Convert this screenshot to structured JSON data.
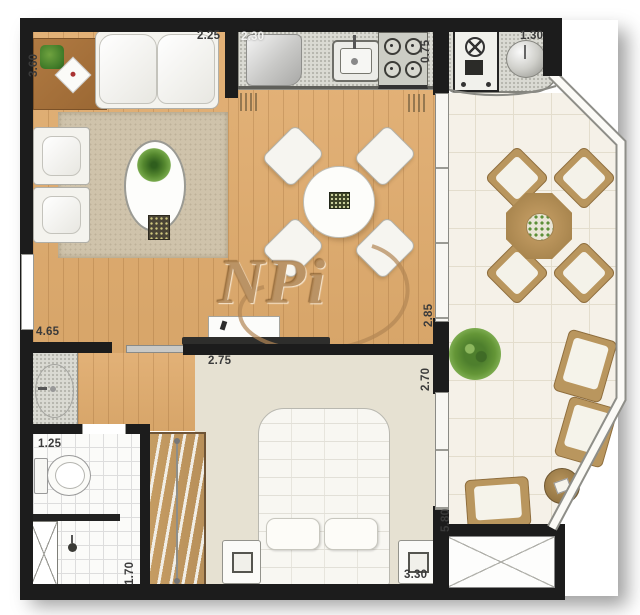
{
  "watermark": {
    "text": "NPi"
  },
  "dimensions": {
    "living_height": "3.60",
    "living_width": "2.25",
    "kitchen_width": "2.30",
    "kitchen_depth": "0.75",
    "grill_width": "1.30",
    "hall_length": "4.65",
    "bedroom_width": "2.75",
    "dining_depth": "2.85",
    "bedroom_depth": "2.70",
    "bathroom_width": "1.25",
    "shower_depth": "1.70",
    "bedroom_length": "3.30",
    "terrace_length": "5.80"
  },
  "colors": {
    "wall": "#1c1c1c",
    "wood_floor": "#ddab71",
    "bedroom_floor": "#e6e1d2",
    "bathroom_floor": "#fbfbf9",
    "terrace_floor": "#f5f1e8",
    "granite_counter": "#dadad3",
    "rug": "#cfc3ab",
    "furniture_wood": "#b9965e",
    "upholstery": "#f4f3ee",
    "plant_green": "#5d8f38",
    "watermark": "#b28654"
  },
  "furniture": [
    "sofa",
    "armchairs",
    "coffee-table",
    "side-table",
    "rug",
    "refrigerator",
    "kitchen-sink",
    "stove",
    "barbecue-grill",
    "round-sink",
    "dining-table",
    "dining-chairs",
    "tv-rack",
    "washbasin",
    "toilet",
    "shower",
    "wardrobe",
    "double-bed",
    "nightstands",
    "terrace-table",
    "terrace-chairs",
    "terrace-armchairs",
    "terrace-side-table",
    "potted-plant",
    "service-shaft"
  ]
}
